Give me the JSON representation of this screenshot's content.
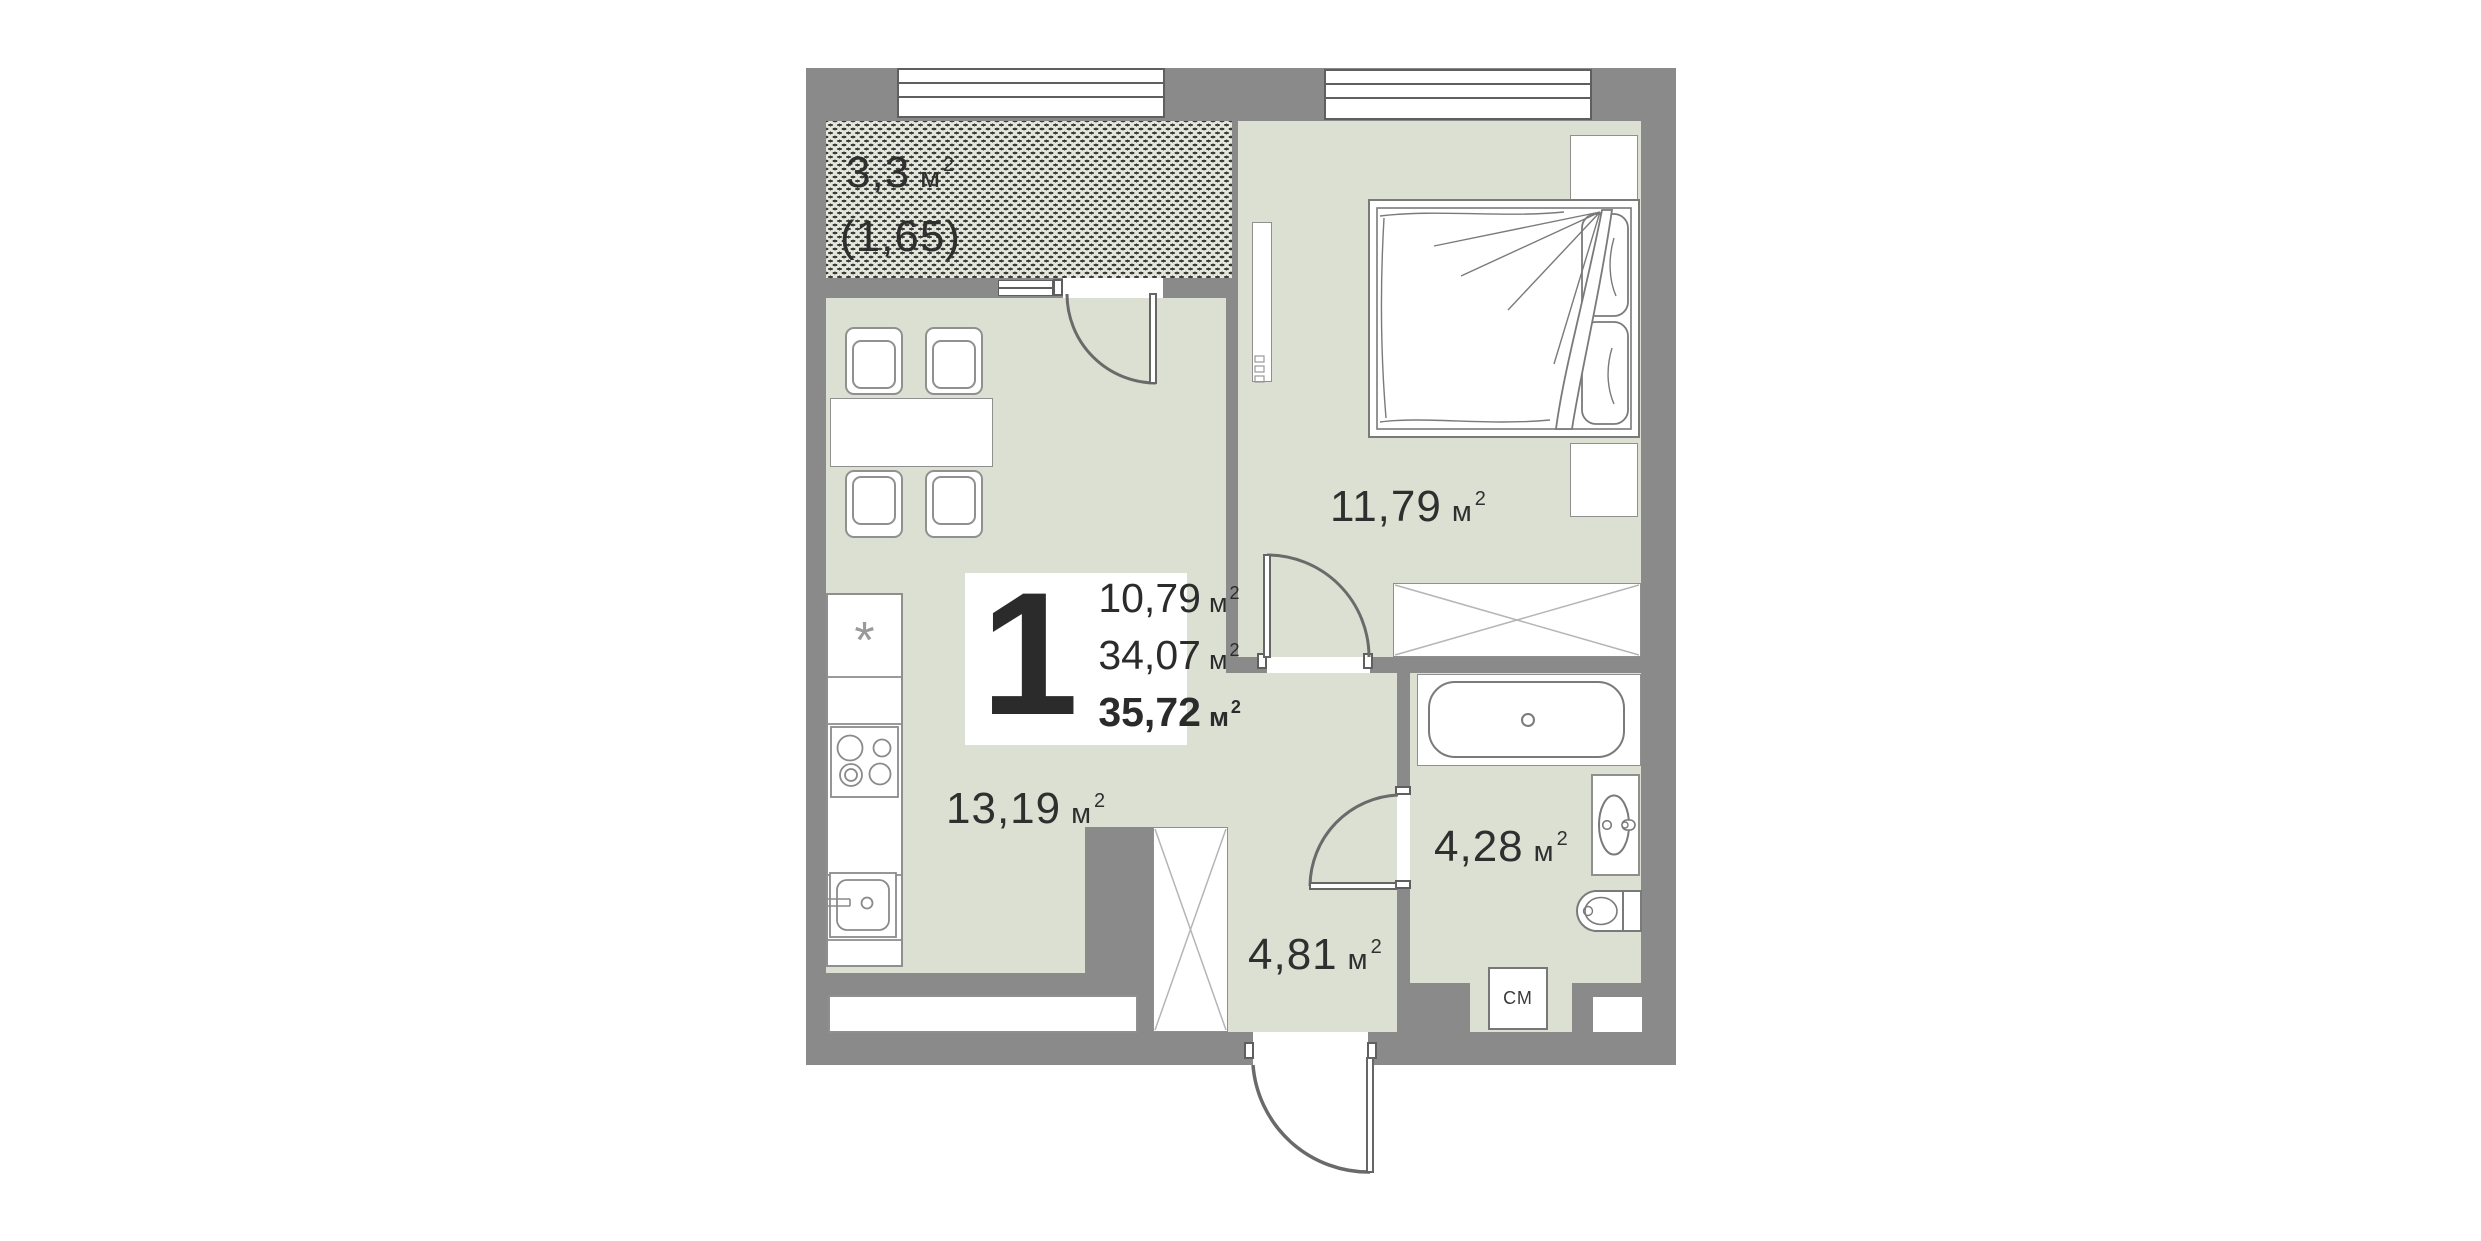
{
  "plan": {
    "unit": "м",
    "unit_sup": "2",
    "rooms": {
      "balcony": {
        "area": "3,3",
        "coef_area": "(1,65)"
      },
      "living_kitchen": {
        "area": "13,19"
      },
      "bedroom": {
        "area": "11,79"
      },
      "hallway": {
        "area": "4,81"
      },
      "bathroom": {
        "area": "4,28"
      }
    },
    "summary": {
      "rooms_count": "1",
      "living_area": "10,79",
      "apartment_area": "34,07",
      "total_area": "35,72"
    },
    "labels": {
      "washing_machine": "СМ",
      "fridge_symbol": "*"
    },
    "colors": {
      "wall": "#8a8a8a",
      "floor": "#dce0d3",
      "balcony_bg": "#e3e6da",
      "hatch_dot": "#3b3b3b",
      "furniture_outline": "#8f8f8f",
      "text": "#2f2f2f",
      "background": "#ffffff"
    }
  }
}
